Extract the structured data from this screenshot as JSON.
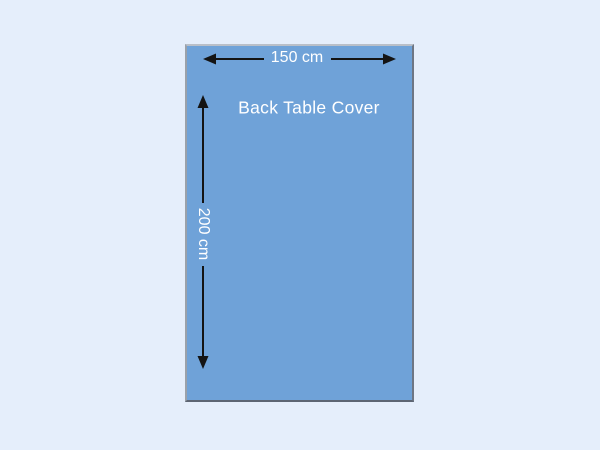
{
  "canvas": {
    "width": 600,
    "height": 450,
    "background_color": "#e5eefb"
  },
  "diagram": {
    "title": "Back Table Cover",
    "width_label": "150 cm",
    "height_label": "200 cm",
    "fill_color": "#6fa2d8",
    "border_color": "#7d828c",
    "arrow_color": "#141414",
    "text_color": "#ffffff"
  }
}
